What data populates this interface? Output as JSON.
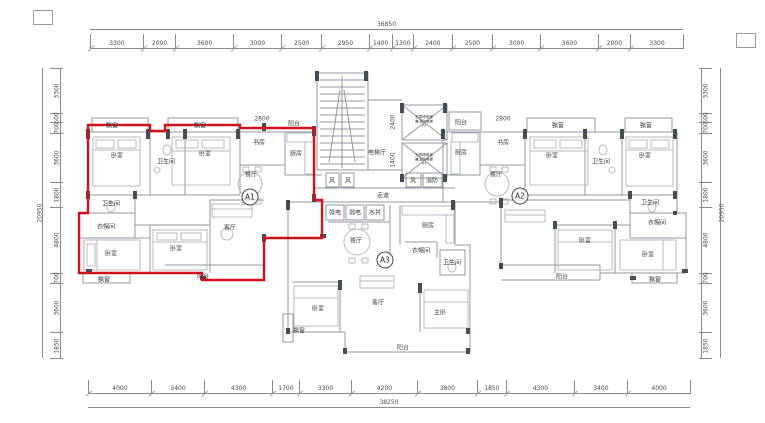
{
  "drawing": {
    "type": "residential-floor-plan",
    "highlighted_unit": "A1"
  },
  "units": [
    {
      "id": "A1",
      "x": 250,
      "y": 197
    },
    {
      "id": "A2",
      "x": 520,
      "y": 196
    },
    {
      "id": "A3",
      "x": 385,
      "y": 260
    }
  ],
  "dimensions": {
    "top": {
      "total": "36850",
      "segments": [
        3300,
        2000,
        3600,
        3000,
        2500,
        2950,
        1400,
        1300,
        2400,
        2500,
        3000,
        3600,
        2000,
        3300
      ]
    },
    "bottom": {
      "total": "38250",
      "segments": [
        4000,
        3400,
        4300,
        1700,
        3300,
        4200,
        3800,
        1850,
        4300,
        3400,
        4000
      ]
    },
    "left": {
      "total": "20950",
      "segments": [
        3300,
        600,
        700,
        3600,
        1800,
        4800,
        700,
        3600,
        1850
      ]
    },
    "right": {
      "total": "20950",
      "segments": [
        3300,
        600,
        700,
        3600,
        1800,
        4800,
        700,
        3600,
        1850
      ]
    }
  },
  "interior_dimensions": [
    {
      "text": "2800",
      "x": 262,
      "y": 119,
      "vertical": false
    },
    {
      "text": "2800",
      "x": 503,
      "y": 119,
      "vertical": false
    },
    {
      "text": "2400",
      "x": 393,
      "y": 122,
      "vertical": true
    },
    {
      "text": "1400",
      "x": 393,
      "y": 160,
      "vertical": true
    }
  ],
  "elevators": [
    {
      "lines": [
        "无障碍电梯",
        "兼消防电梯",
        "02"
      ],
      "x": 424,
      "y": 122
    },
    {
      "lines": [
        "无障碍电梯",
        "兼消防电梯",
        "01"
      ],
      "x": 424,
      "y": 160
    }
  ],
  "room_labels": [
    {
      "t": "飘窗",
      "x": 112,
      "y": 125
    },
    {
      "t": "飘窗",
      "x": 200,
      "y": 125
    },
    {
      "t": "阳台",
      "x": 294,
      "y": 123
    },
    {
      "t": "卧室",
      "x": 117,
      "y": 155
    },
    {
      "t": "卫生间",
      "x": 166,
      "y": 161
    },
    {
      "t": "卧室",
      "x": 205,
      "y": 153
    },
    {
      "t": "书房",
      "x": 259,
      "y": 142
    },
    {
      "t": "厨房",
      "x": 296,
      "y": 153
    },
    {
      "t": "餐厅",
      "x": 251,
      "y": 174
    },
    {
      "t": "卫生间",
      "x": 111,
      "y": 203
    },
    {
      "t": "衣帽间",
      "x": 106,
      "y": 226
    },
    {
      "t": "卧室",
      "x": 111,
      "y": 253
    },
    {
      "t": "飘窗",
      "x": 104,
      "y": 279
    },
    {
      "t": "卧室",
      "x": 176,
      "y": 248
    },
    {
      "t": "客厅",
      "x": 230,
      "y": 227
    },
    {
      "t": "阳台",
      "x": 203,
      "y": 276
    },
    {
      "t": "电梯厅",
      "x": 377,
      "y": 152
    },
    {
      "t": "走道",
      "x": 383,
      "y": 195
    },
    {
      "t": "风",
      "x": 332,
      "y": 180
    },
    {
      "t": "风",
      "x": 348,
      "y": 180
    },
    {
      "t": "风",
      "x": 413,
      "y": 180
    },
    {
      "t": "消防",
      "x": 432,
      "y": 180
    },
    {
      "t": "强电",
      "x": 335,
      "y": 212
    },
    {
      "t": "弱电",
      "x": 355,
      "y": 212
    },
    {
      "t": "水井",
      "x": 375,
      "y": 212
    },
    {
      "t": "餐厅",
      "x": 356,
      "y": 240
    },
    {
      "t": "厨房",
      "x": 428,
      "y": 225
    },
    {
      "t": "衣帽间",
      "x": 421,
      "y": 250
    },
    {
      "t": "卫生间",
      "x": 452,
      "y": 262
    },
    {
      "t": "卧室",
      "x": 318,
      "y": 308
    },
    {
      "t": "飘窗",
      "x": 299,
      "y": 330
    },
    {
      "t": "客厅",
      "x": 378,
      "y": 302
    },
    {
      "t": "主卧",
      "x": 440,
      "y": 312
    },
    {
      "t": "阳台",
      "x": 403,
      "y": 347
    },
    {
      "t": "阳台",
      "x": 461,
      "y": 122
    },
    {
      "t": "厨房",
      "x": 461,
      "y": 152
    },
    {
      "t": "书房",
      "x": 503,
      "y": 142
    },
    {
      "t": "餐厅",
      "x": 496,
      "y": 174
    },
    {
      "t": "飘窗",
      "x": 558,
      "y": 125
    },
    {
      "t": "卧室",
      "x": 552,
      "y": 155
    },
    {
      "t": "卫生间",
      "x": 601,
      "y": 161
    },
    {
      "t": "飘窗",
      "x": 646,
      "y": 125
    },
    {
      "t": "卧室",
      "x": 645,
      "y": 155
    },
    {
      "t": "卫生间",
      "x": 650,
      "y": 202
    },
    {
      "t": "衣帽间",
      "x": 657,
      "y": 222
    },
    {
      "t": "卧室",
      "x": 585,
      "y": 240
    },
    {
      "t": "卧室",
      "x": 648,
      "y": 254
    },
    {
      "t": "飘窗",
      "x": 655,
      "y": 279
    },
    {
      "t": "阳台",
      "x": 562,
      "y": 276
    }
  ],
  "colors": {
    "highlight_outline": "#d0121a",
    "wall_dark": "#474b52",
    "wall_light": "#9298a2",
    "furniture": "#b6bac2",
    "dim_line": "#8a8a8a"
  }
}
